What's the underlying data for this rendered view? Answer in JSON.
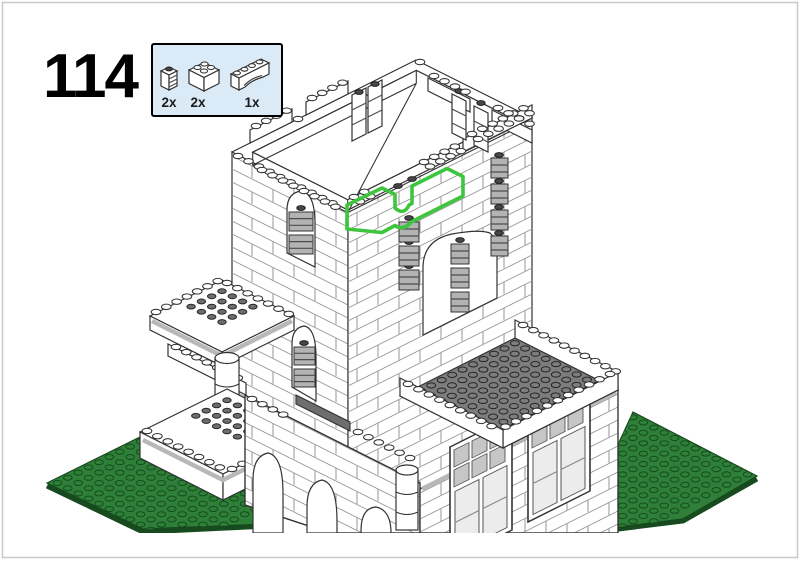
{
  "page": {
    "step_number": "114"
  },
  "parts_callout": {
    "parts": [
      {
        "name": "brick-1x1-with-grille",
        "count": "2x"
      },
      {
        "name": "brick-2x2",
        "count": "2x"
      },
      {
        "name": "arch-brick-1x4",
        "count": "1x"
      }
    ]
  },
  "illustration": {
    "description": "Isometric line drawing of a white modular castle-style building on a green studded baseplate; a bright green outline highlights the bricks newly placed in this step on top of the tower's front wall, including an arch over a window recess",
    "highlighted_parts": [
      "brick-2x2",
      "brick-2x2",
      "arch-brick-1x4",
      "brick-1x1-with-grille",
      "brick-1x1-with-grille"
    ]
  },
  "colors": {
    "page_bg": "#ffffff",
    "page_border": "#c9c9c9",
    "callout_bg": "#daeaf6",
    "callout_border": "#000000",
    "outline": "#333333",
    "highlight": "#3dc53d",
    "baseplate": "#2e8039",
    "baseplate_dark": "#174a1e",
    "roof": "#7d7d7d",
    "tile": "#b8b8b8",
    "grille": "#b3b3b3",
    "dark_stud": "#474747",
    "text": "#000000"
  }
}
